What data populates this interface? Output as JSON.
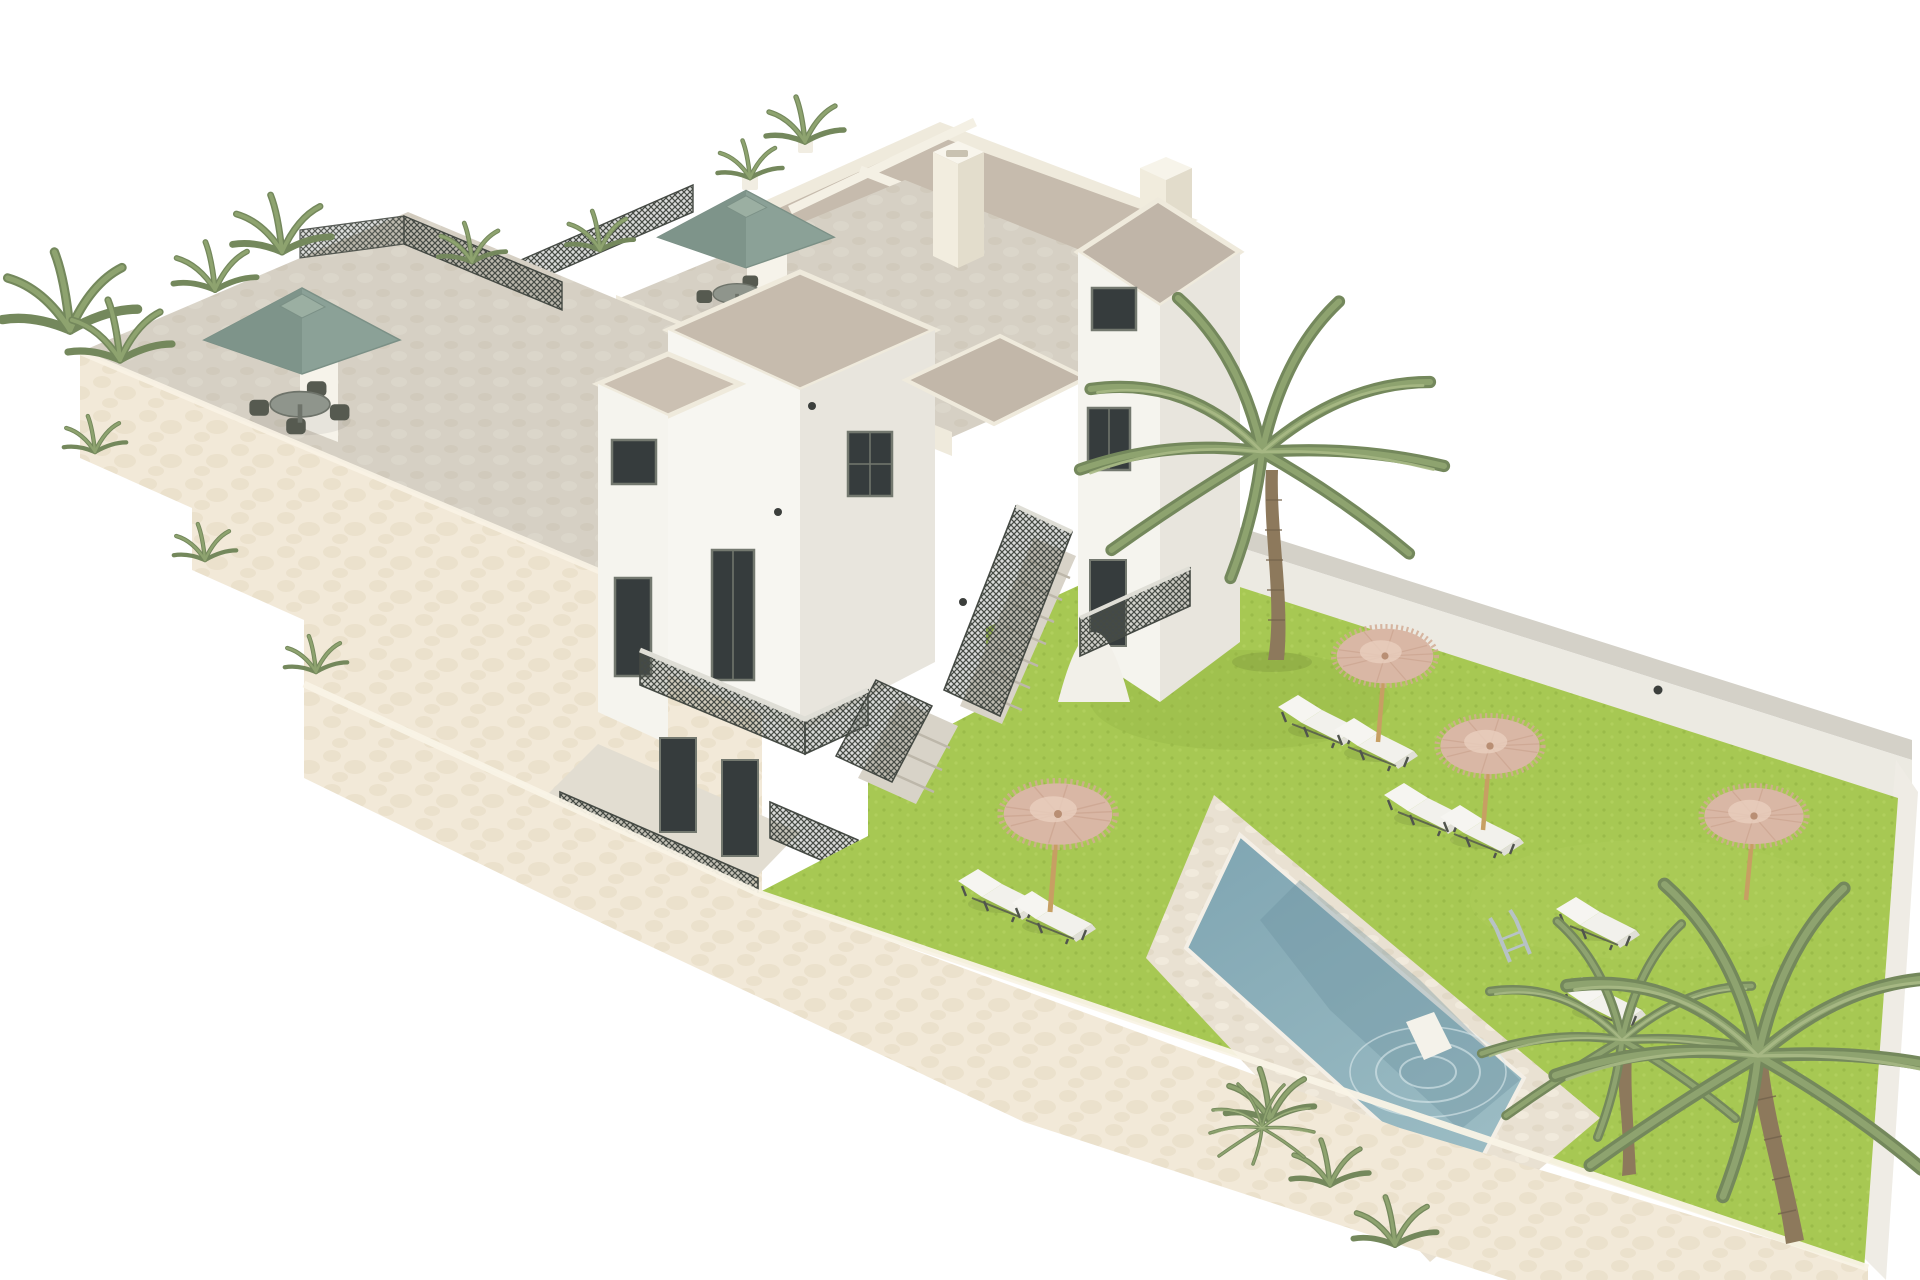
{
  "meta": {
    "title": "3D architectural rendering of a whitewashed apartment complex with roof terraces, garden and pool",
    "view": "isometric aerial",
    "background": "#ffffff"
  },
  "palette": {
    "bg": "#ffffff",
    "stucco": "#f2e9d8",
    "stuccoShade": "#e8ddc7",
    "wallLit": "#f7f6f1",
    "wallShade": "#e8e5dd",
    "wallBright": "#fbfaf7",
    "parapet": "#efeadc",
    "roof": "#c6bbad",
    "roofDark": "#b7ac9e",
    "terraceFloor": "#d6d0c4",
    "patioFloor": "#e2ddd1",
    "mesh": "#454a44",
    "glass": "#363c3d",
    "frame": "#73786f",
    "grass": "#a7c853",
    "grassDark": "#94b645",
    "deck": "#e9e1d2",
    "water": "#8cafba",
    "waterDark": "#6a8f9e",
    "ripple": "#dceaed",
    "straw": "#d9b7a5",
    "strawDark": "#c9a18c",
    "strawLight": "#e8cebe",
    "strawPole": "#c79f63",
    "sage": "#8ba197",
    "sageDark": "#7e948a",
    "sageLight": "#9bafa2",
    "lounger": "#f2f1ec",
    "loungerShade": "#e0dfd7",
    "frameDark": "#50544d",
    "palm": "#8ea36f",
    "palmLight": "#a9ba86",
    "palmDark": "#74885c",
    "trunk": "#8d795c",
    "tableGray": "#8f958c",
    "chairDark": "#565a50",
    "wallTopGray": "#d4d1c8",
    "wallFaceGray": "#eceae2",
    "ladder": "#b7c2c5",
    "lampDark": "#3c3f3c"
  },
  "scene": {
    "areas": [
      {
        "label": "roof terrace west",
        "features": [
          "sage-green cantilever parasol",
          "round table with four chairs",
          "potted plants",
          "dark lattice railing",
          "stepped stucco wall with planters"
        ]
      },
      {
        "label": "roof terrace center",
        "features": [
          "sage-green cantilever parasol",
          "table with two chairs",
          "potted plants",
          "white chimney stacks",
          "flat beige roof panels"
        ]
      },
      {
        "label": "apartment buildings",
        "features": [
          "white cubic towers",
          "flat greige roofs",
          "dark framed windows and doors",
          "balconies with dark mesh railings",
          "external staircase with mesh railing",
          "wall sconces"
        ]
      },
      {
        "label": "garden",
        "features": [
          "bright green lawn",
          "tall palm tree",
          "four straw parasols",
          "white sun loungers",
          "rectangular pool with beige deck",
          "chrome pool ladder",
          "white pool step",
          "corner palm trees",
          "cream perimeter wall"
        ]
      }
    ],
    "counts": {
      "green_parasols": 2,
      "straw_parasols": 4,
      "sun_loungers": 8,
      "palm_trees": 3,
      "pools": 1,
      "chimneys": 2
    }
  }
}
